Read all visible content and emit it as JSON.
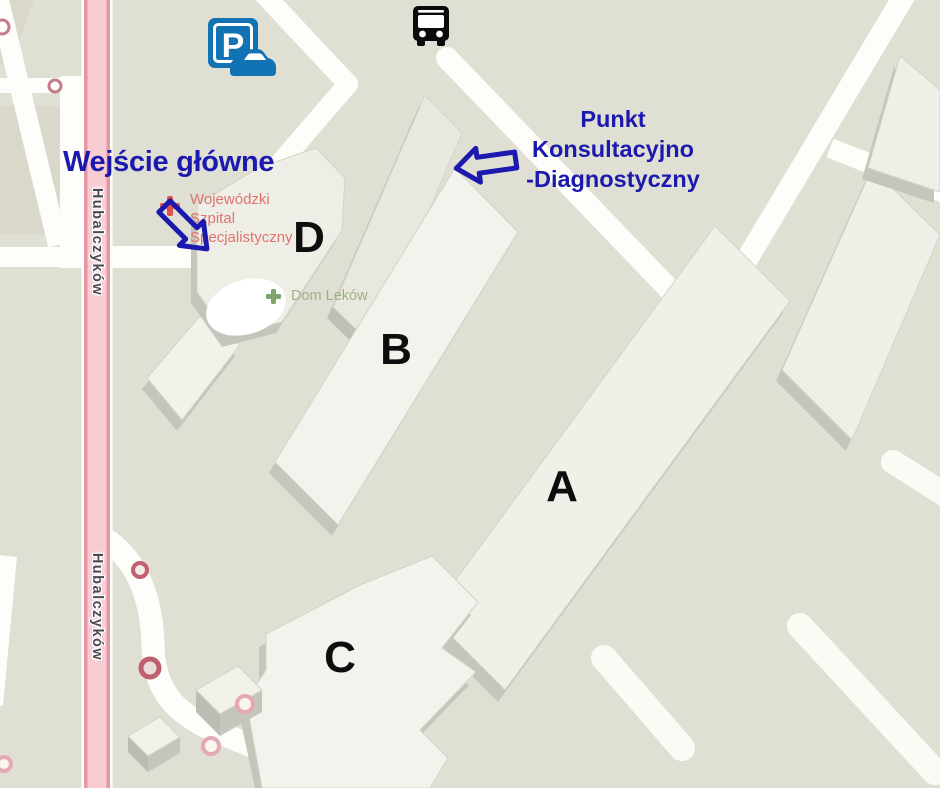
{
  "colors": {
    "ground": "#e0dfd4",
    "building_top": "#f2f1ea",
    "building_side": "#c6c5bc",
    "road_white": "#fdfdfa",
    "road_pink": "#f8ccd3",
    "road_pink_stripe": "#e695a2",
    "annotation_blue": "#1b19ae",
    "parking_blue": "#1173b4",
    "hospital_red": "#e2544b",
    "hospital_text": "#e0746d",
    "pharmacy_green": "#7fa468",
    "pharmacy_text": "#9cb183",
    "poi_ring_dark": "#c2606f",
    "poi_ring_light": "#e4aab4"
  },
  "streets": {
    "labels": [
      "Hubalczyków",
      "Hubalczyków"
    ]
  },
  "buildings": {
    "a": "A",
    "b": "B",
    "c": "C",
    "d": "D"
  },
  "pois": {
    "hospital": {
      "line1": "Wojewódzki",
      "line2": "Szpital",
      "line3": "Specjalistyczny"
    },
    "pharmacy": {
      "label": "Dom Leków"
    }
  },
  "annotations": {
    "main_entrance": "Wejście główne",
    "pkd": {
      "line1": "Punkt",
      "line2": "Konsultacyjno",
      "line3": "-Diagnostyczny"
    }
  },
  "icons": {
    "parking": {
      "name": "parking-icon",
      "letter": "P"
    },
    "bus": {
      "name": "bus-icon"
    }
  }
}
